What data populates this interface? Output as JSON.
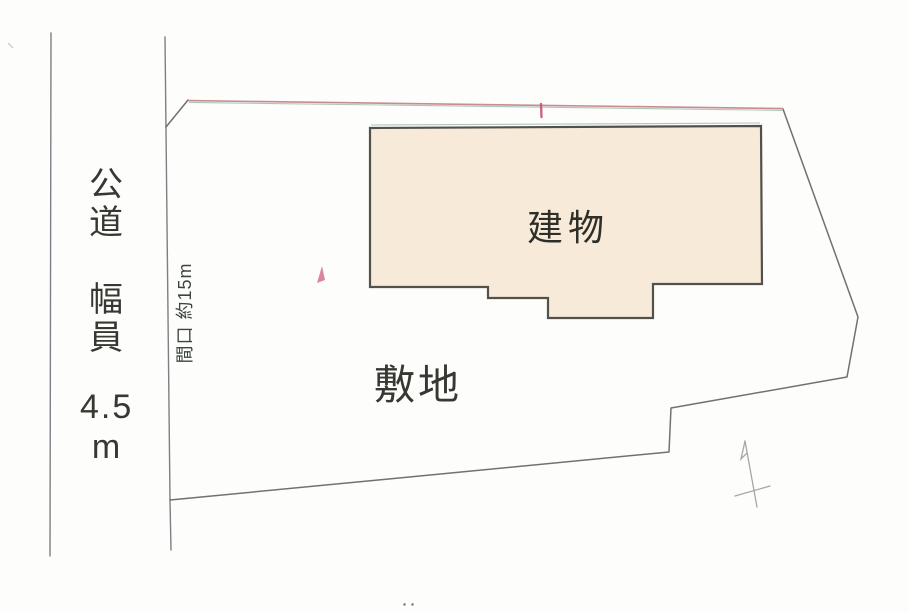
{
  "colors": {
    "building_fill": "#f8ead9",
    "building_stroke": "#52514a",
    "boundary": "#70736a",
    "road_line": "#7b8084",
    "accent_pink": "#c4566f",
    "fringe_pink": "#c98b8b",
    "fringe_teal": "#9fbcb4",
    "faint_mark": "#a3a8a6",
    "text": "#383832"
  },
  "road": {
    "name_chars": [
      "公",
      "道"
    ],
    "width_chars": [
      "幅",
      "員"
    ],
    "width_value": "4.5",
    "width_unit": "m"
  },
  "site": {
    "label": "敷地",
    "frontage_label": "間口 約15m"
  },
  "building": {
    "label": "建物"
  }
}
